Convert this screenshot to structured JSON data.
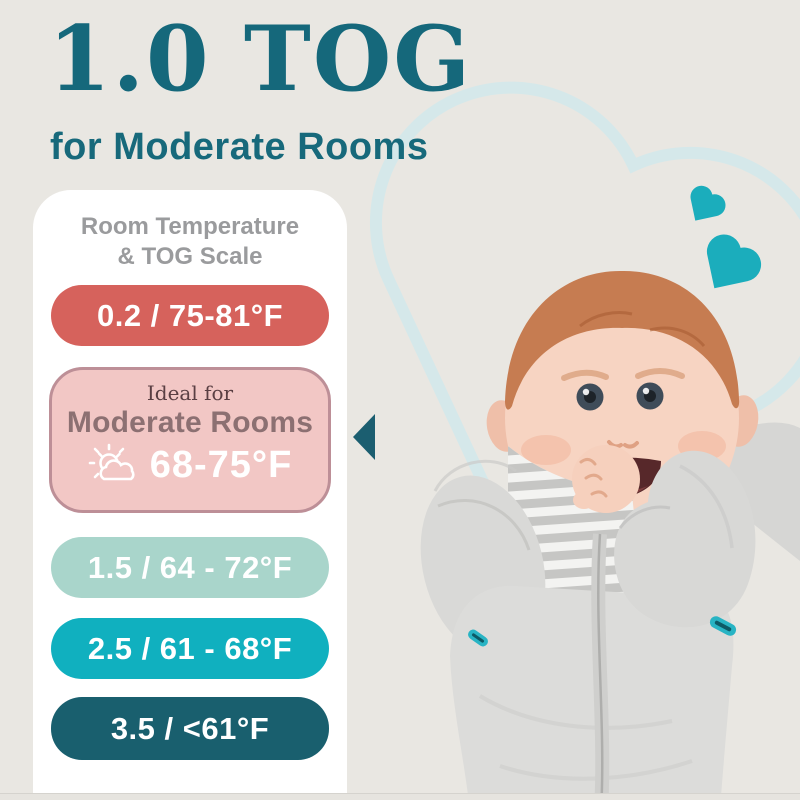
{
  "page": {
    "background": "#e9e7e2",
    "title": "1.0 TOG",
    "title_color": "#15687b",
    "subtitle": "for Moderate Rooms"
  },
  "card": {
    "heading_line1": "Room Temperature",
    "heading_line2": "& TOG Scale",
    "heading_color": "#9a9b9d",
    "scale": [
      {
        "label": "0.2 / 75-81°F",
        "color": "#d6625c",
        "text_color": "#ffffff"
      },
      {
        "label": "1.5 / 64 - 72°F",
        "color": "#a9d5cb",
        "text_color": "#ffffff"
      },
      {
        "label": "2.5 / 61 - 68°F",
        "color": "#10b0bf",
        "text_color": "#ffffff"
      },
      {
        "label": "3.5 / <61°F",
        "color": "#195f6e",
        "text_color": "#ffffff"
      }
    ],
    "ideal": {
      "eyebrow": "Ideal for",
      "room": "Moderate Rooms",
      "temp": "68-75°F",
      "icon": "sun-behind-cloud-icon",
      "fill": "#f2c7c5",
      "border": "#bd8f97",
      "eyebrow_color": "#5a3f43",
      "room_color": "#8c7072",
      "temp_color": "#ffffff"
    },
    "pointer_color": "#1b5e70"
  },
  "decor": {
    "solid_heart_color": "#1badbc",
    "heart_outline_color": "#d5e8ea"
  },
  "photo": {
    "description": "Smiling baby with hand in mouth wearing a gray swaddle sleep sack with center zipper and teal zip pulls",
    "swaddle_color": "#d8d8d6",
    "zip_pull_color": "#28b4c4"
  }
}
